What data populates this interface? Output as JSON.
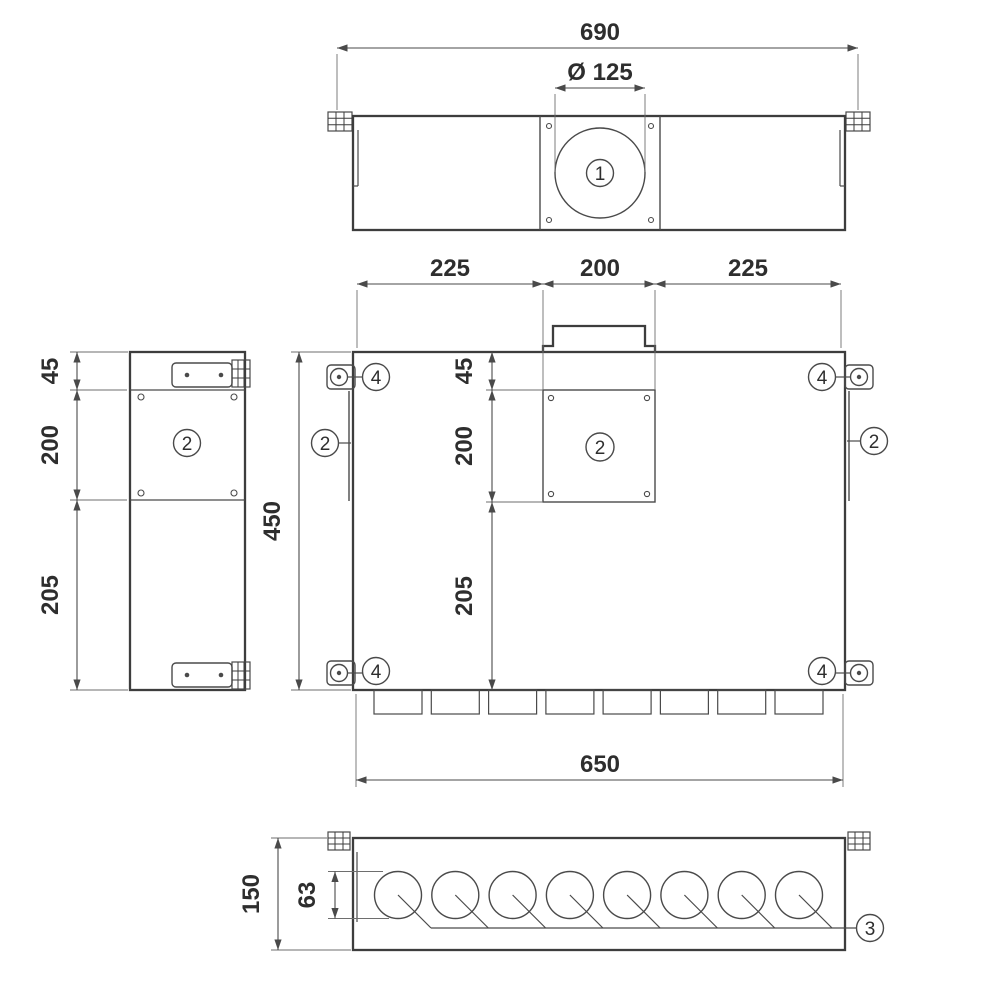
{
  "top_view": {
    "dim_overall_width": "690",
    "dim_spigot_diameter": "Ø 125",
    "callout_inlet_spigot": "1"
  },
  "front_view": {
    "dim_segment_left": "225",
    "dim_segment_center": "200",
    "dim_segment_right": "225",
    "dim_top_offset": "45",
    "dim_access_panel": "200",
    "dim_lower_section": "205",
    "dim_overall_height": "450",
    "dim_overall_width": "650",
    "callout_access_panel": "2",
    "callout_side_panel_left": "2",
    "callout_side_panel_right": "2",
    "callout_mounting_bracket": "4"
  },
  "side_view": {
    "dim_top_offset": "45",
    "dim_access_panel": "200",
    "dim_lower_section": "205",
    "callout_access_panel": "2"
  },
  "bottom_view": {
    "dim_overall_depth": "150",
    "dim_outlet_diameter": "63",
    "callout_outlets": "3"
  }
}
